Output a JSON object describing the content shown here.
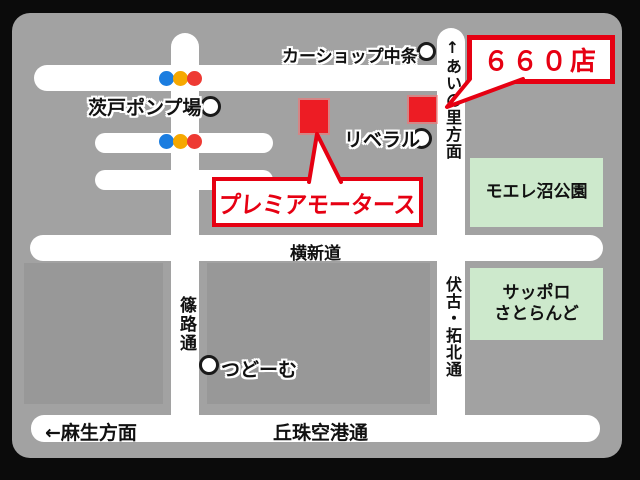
{
  "map": {
    "callouts": {
      "store_number": "６６０店",
      "store_name": "プレミアモータース"
    },
    "roads": {
      "yoko_shindo": "横新道",
      "shinoro_dori": "篠路通",
      "fushiko_takuhoku_dori": "伏古・拓北通",
      "ainosato_direction": "↑あいの里方面",
      "asabu_direction": "←麻生方面",
      "okadama_airport_dori": "丘珠空港通"
    },
    "landmarks": {
      "car_shop_nakajo": "カーショップ中条",
      "barato_pump_station": "茨戸ポンプ場",
      "liberal": "リベラル",
      "tsudome": "つどーむ",
      "moere_numa_park": "モエレ沼公園",
      "sapporo_satoland_line1": "サッポロ",
      "sapporo_satoland_line2": "さとらんど"
    },
    "colors": {
      "frame": "#0b0b0b",
      "map_bg": "#a2a2a2",
      "city_block": "#989898",
      "road": "#ffffff",
      "accent_red": "#e60012",
      "marker_red": "#ed1c24",
      "green_area": "#cde9cc",
      "signal_blue": "#1b7de0",
      "signal_yellow": "#f6a800",
      "signal_red": "#ee3a33"
    }
  }
}
